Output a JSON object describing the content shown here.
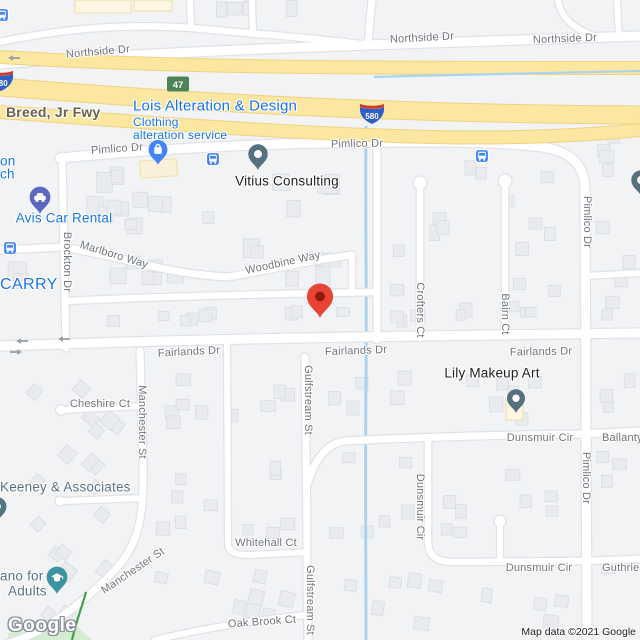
{
  "map": {
    "attribution": "Map data ©2021 Google",
    "logo_text": "Google",
    "colors": {
      "land": "#f2f3f5",
      "road_fill": "#ffffff",
      "road_casing": "#dfe2e7",
      "freeway_fill": "#fbe7a0",
      "freeway_casing": "#efd283",
      "water": "#a9d3f2",
      "trail_green": "#43a047",
      "park_green": "#d4ecd0",
      "building": "#e9ebee",
      "building_stroke": "#d9dce1",
      "commercial_fill": "#fdf6e3",
      "commercial_stroke": "#eedfa9",
      "street_label": "#70757a",
      "poi_blue": "#1a73e8",
      "poi_dark": "#202124",
      "poi_muted": "#5b7282",
      "pin_blue": "#4285f4",
      "pin_slate": "#56707e",
      "pin_purple": "#5b68c0",
      "pin_teal": "#3d939f",
      "pin_steel": "#4f7482",
      "bus_blue": "#4285f4",
      "marker_red": "#ea4335",
      "marker_red_dark": "#8f1b0c",
      "shield_green": "#4d8457",
      "shield_blue": "#2e5ec9",
      "shield_red": "#c63d32",
      "arrow_grey": "#9aa0a6"
    },
    "shields": {
      "route_47": "47",
      "interstate_580": "580"
    },
    "streets": {
      "northside_1": "Northside Dr",
      "northside_2": "Northside Dr",
      "northside_3": "Northside Dr",
      "breed_fwy": "Breed, Jr Fwy",
      "pimlico_1": "Pimlico Dr",
      "pimlico_2": "Pimlico Dr",
      "pimlico_3": "Pimlico Dr",
      "pimlico_4": "Pimlico Dr",
      "marlboro": "Marlboro Way",
      "woodbine": "Woodbine Way",
      "brockton": "Brockton Dr",
      "fairlands_1": "Fairlands Dr",
      "fairlands_2": "Fairlands Dr",
      "fairlands_3": "Fairlands Dr",
      "cheshire": "Cheshire Ct",
      "manchester_1": "Manchester St",
      "manchester_2": "Manchester St",
      "gulfstream_1": "Gulfstream St",
      "gulfstream_2": "Gulfstream St",
      "whitehall": "Whitehall Ct",
      "oak_brook": "Oak Brook Ct",
      "crofters": "Crofters Ct",
      "bairn": "Bairn Ct",
      "dunsmuir_1": "Dunsmuir Cir",
      "dunsmuir_2": "Dunsmuir Cir",
      "dunsmuir_3": "Dunsmuir Cir",
      "ballantyne_partial": "Ballanty",
      "guthrie": "Guthrie"
    },
    "pois": {
      "lois": {
        "name": "Lois Alteration & Design",
        "category_line1": "Clothing",
        "category_line2": "alteration service"
      },
      "vitius": {
        "name": "Vitius Consulting"
      },
      "avis": {
        "name": "Avis Car Rental"
      },
      "lily": {
        "name": "Lily Makeup Art"
      },
      "keeney": {
        "name": "Keeney & Associates"
      },
      "adults_school": {
        "name_line1": "ano for",
        "name_line2": "Adults"
      },
      "carry_partial": {
        "name": "CARRY"
      },
      "left_edge_partial": {
        "line1": "on",
        "line2": "ch"
      }
    }
  }
}
